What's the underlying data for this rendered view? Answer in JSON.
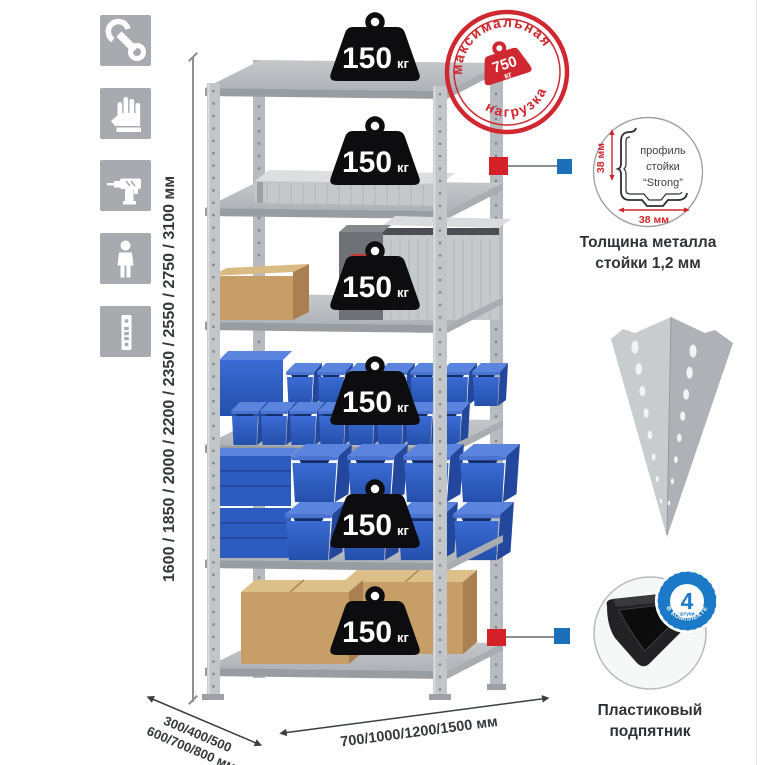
{
  "sidebar": {
    "icons": [
      {
        "name": "wrench-icon"
      },
      {
        "name": "gloves-icon"
      },
      {
        "name": "drill-icon"
      },
      {
        "name": "person-icon"
      },
      {
        "name": "perforated-post-icon"
      }
    ]
  },
  "dimensions": {
    "height": "1600 / 1850 / 2000 / 2200 / 2350 / 2550 / 2750 / 3100 мм",
    "depth_line1": "300/400/500",
    "depth_line2": "600/700/800 мм",
    "width": "700/1000/1200/1500 мм"
  },
  "shelf_weights": [
    {
      "value": "150",
      "unit": "кг"
    },
    {
      "value": "150",
      "unit": "кг"
    },
    {
      "value": "150",
      "unit": "кг"
    },
    {
      "value": "150",
      "unit": "кг"
    },
    {
      "value": "150",
      "unit": "кг"
    },
    {
      "value": "150",
      "unit": "кг"
    }
  ],
  "max_load_stamp": {
    "arc_top": "максимальная",
    "arc_bottom": "нагрузка",
    "value": "750",
    "unit": "кг"
  },
  "profile_detail": {
    "line1": "профиль",
    "line2": "стойки",
    "line3": "“Strong”",
    "dim_vertical": "38 мм",
    "dim_horizontal": "38 мм",
    "caption_line1": "Толщина металла",
    "caption_line2": "стойки 1,2 мм"
  },
  "foot_detail": {
    "badge_value": "4",
    "badge_unit": "штуки",
    "badge_arc": "В КОМПЛЕКТЕ",
    "caption_line1": "Пластиковый",
    "caption_line2": "подпятник"
  },
  "colors": {
    "accent_red": "#d0242b",
    "accent_blue": "#1b79c8",
    "stamp_red": "#cf2830",
    "bin_blue": "#2e5fc6",
    "cardboard": "#c49a64",
    "metal_gray": "#bfc2c5",
    "icon_gray": "#a7abb0"
  }
}
